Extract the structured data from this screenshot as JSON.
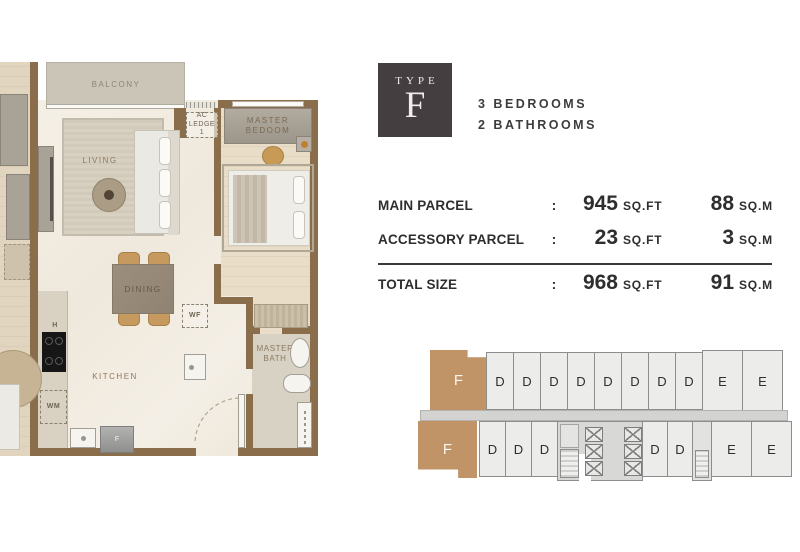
{
  "floorplan": {
    "balcony": "BALCONY",
    "living": "LIVING",
    "dining": "DINING",
    "kitchen": "KITCHEN",
    "master_bedroom_line1": "MASTER",
    "master_bedroom_line2": "BEDOOM",
    "master_bath_line1": "MASTER",
    "master_bath_line2": "BATH",
    "ac_ledge_line1": "AC",
    "ac_ledge_line2": "LEDGE",
    "ac_ledge_line3": "1",
    "wf": "WF",
    "wm": "WM",
    "hob": "H",
    "fridge": "F"
  },
  "unit_info": {
    "type_word": "TYPE",
    "type_letter": "F",
    "line1": "3 BEDROOMS",
    "line2": "2 BATHROOMS"
  },
  "size_table": {
    "rows": [
      {
        "label": "MAIN PARCEL",
        "sep": ":",
        "value_sqft": "945",
        "unit_sqft": "SQ.FT",
        "value_sqm": "88",
        "unit_sqm": "SQ.M"
      },
      {
        "label": "ACCESSORY PARCEL",
        "sep": ":",
        "value_sqft": "23",
        "unit_sqft": "SQ.FT",
        "value_sqm": "3",
        "unit_sqm": "SQ.M"
      },
      {
        "label": "TOTAL SIZE",
        "sep": ":",
        "value_sqft": "968",
        "unit_sqft": "SQ.FT",
        "value_sqm": "91",
        "unit_sqm": "SQ.M"
      }
    ]
  },
  "keyplan": {
    "f_top": "F",
    "f_bottom": "F",
    "top_d": [
      "D",
      "D",
      "D",
      "D",
      "D",
      "D",
      "D",
      "D"
    ],
    "top_e": [
      "E",
      "E"
    ],
    "bottom_d_left": [
      "D",
      "D",
      "D"
    ],
    "bottom_d_right": [
      "D",
      "D"
    ],
    "bottom_e": [
      "E",
      "E"
    ]
  },
  "colors": {
    "wall": "#8a6d4b",
    "unit_f_highlight": "#c09467",
    "badge_background": "#453e41",
    "text_dark": "#2e2e2e",
    "keyplan_cell": "#ececea"
  }
}
